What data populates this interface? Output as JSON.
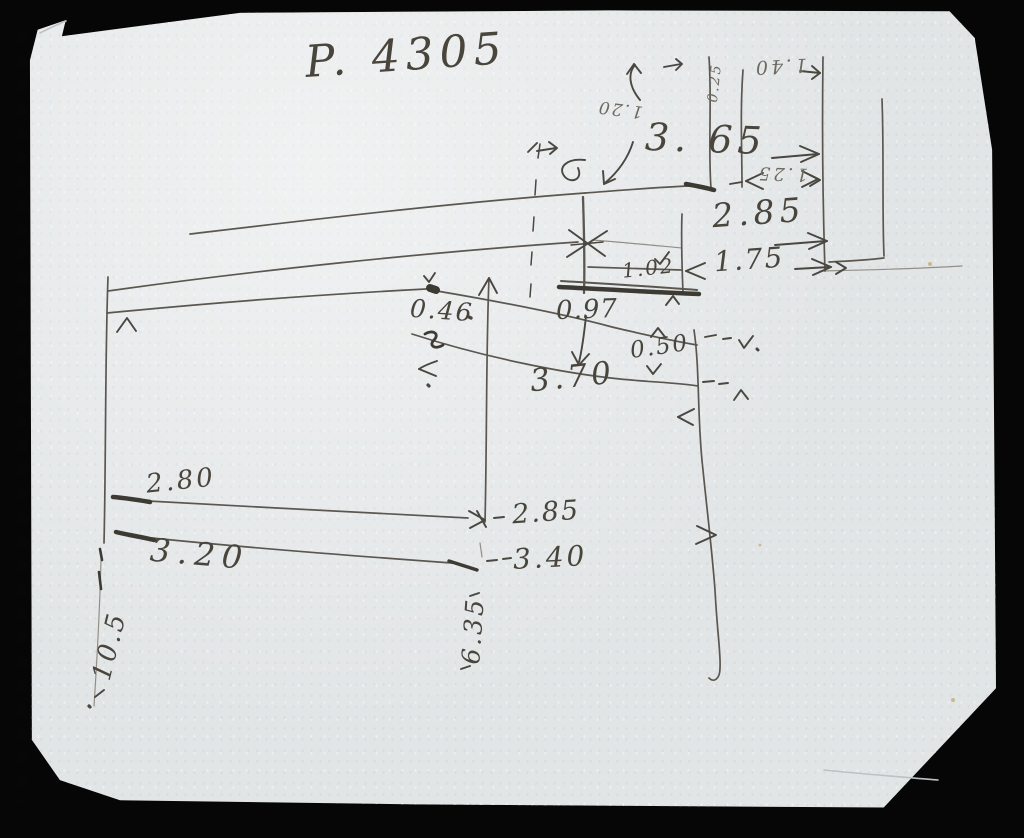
{
  "colors": {
    "photo_background": "#060606",
    "paper": "#e2e5e6",
    "pencil": "#55514a",
    "pencil_dark": "#3d3a34"
  },
  "sketch": {
    "title": "P. 4305",
    "measurements": {
      "top_small_rotated": "0.25",
      "top_upside_down": "1.40",
      "left_of_3_65_rotated": "1.20",
      "d3_65": "3. 65",
      "d1_25": "1.25",
      "d2_85_right": "2.85",
      "d1_75": "1.75",
      "d1_02": "1.02",
      "d0_46": "0.46",
      "d0_97": "0.97",
      "d0_50": "0.50",
      "d3_70": "3.70",
      "d2_80": "2.80",
      "d2_85_mid": "2.85",
      "d3_20": "3.20",
      "d3_40": "3.40",
      "d6_35": "6.35",
      "d10_5": "10.5"
    }
  }
}
